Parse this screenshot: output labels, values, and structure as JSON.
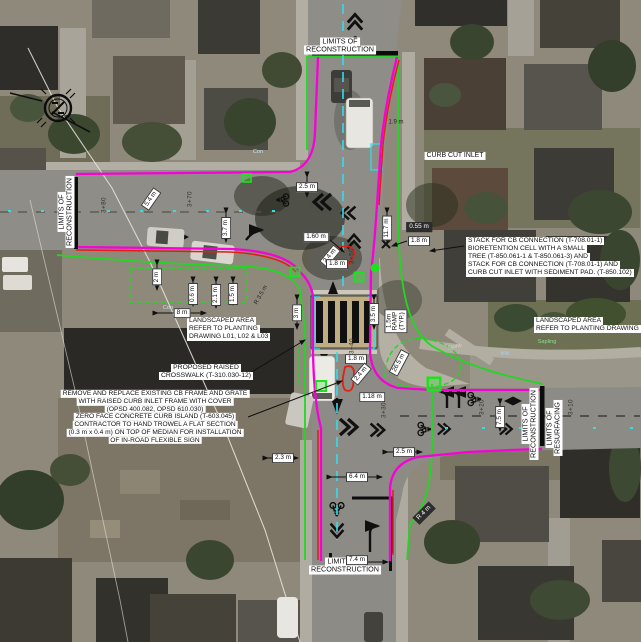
{
  "drawing": {
    "type_label": "intersection reconstruction plan over aerial photo",
    "colors": {
      "proposed_curb_magenta": "#f702d6",
      "limits_green": "#21d821",
      "centerline_cyan": "#34dce9",
      "existing_remove_red": "#e02015",
      "marking_black": "#101010",
      "label_bg": "#ffffff",
      "label_text": "#0f0f0f"
    }
  },
  "annotations": [
    {
      "id": "limits-of-reconstruction-top",
      "lines": [
        "LIMITS OF",
        "RECONSTRUCTION"
      ],
      "x": 340,
      "y": 46,
      "rot": 0,
      "anchor": "c",
      "cls": "center",
      "fs": 7.2
    },
    {
      "id": "limits-of-reconstruction-left",
      "lines": [
        "LIMITS OF",
        "RECONSTRUCTION"
      ],
      "x": 66,
      "y": 212,
      "rot": -90,
      "anchor": "c",
      "cls": "center",
      "fs": 7.2
    },
    {
      "id": "limits-of-reconstruction-right",
      "lines": [
        "LIMITS OF",
        "RECONSTRUCTION"
      ],
      "x": 530,
      "y": 424,
      "rot": -90,
      "anchor": "c",
      "cls": "center",
      "fs": 7.2
    },
    {
      "id": "limits-of-resurfacing-right",
      "lines": [
        "LIMITS OF",
        "RESURFACING"
      ],
      "x": 554,
      "y": 428,
      "rot": -90,
      "anchor": "c",
      "cls": "center",
      "fs": 7.2
    },
    {
      "id": "limits-of-reconstruction-bottom",
      "lines": [
        "LIMITS OF",
        "RECONSTRUCTION"
      ],
      "x": 345,
      "y": 566,
      "rot": 0,
      "anchor": "c",
      "cls": "center",
      "fs": 7.2
    },
    {
      "id": "curb-cut-inlet-note",
      "lines": [
        "CURB CUT INLET"
      ],
      "x": 455,
      "y": 156,
      "rot": 0,
      "anchor": "c",
      "cls": "center",
      "fs": 6.9
    },
    {
      "id": "stack-cb-connection-note",
      "lines": [
        "STACK FOR CB CONNECTION (T-708.01-1)",
        "BIORETENTION CELL WITH A SMALL",
        "TREE (T-850.061-1 & T-850.061-3) AND",
        "STACK FOR CB CONNECTION (T-708.01-1) AND",
        "CURB CUT INLET WITH SEDIMENT PAD. (T-850.102)"
      ],
      "x": 466,
      "y": 237,
      "rot": 0,
      "anchor": "tl",
      "cls": "left",
      "fs": 6.7
    },
    {
      "id": "landscaped-area-left-note",
      "lines": [
        "LANDSCAPED AREA",
        "REFER TO PLANTING",
        "DRAWING L01, L02 & L03"
      ],
      "x": 187,
      "y": 317,
      "rot": 0,
      "anchor": "tl",
      "cls": "left",
      "fs": 6.7
    },
    {
      "id": "landscaped-area-right-note",
      "lines": [
        "LANDSCAPED AREA",
        "REFER TO PLANTING DRAWING L01"
      ],
      "x": 534,
      "y": 317,
      "rot": 0,
      "anchor": "tl",
      "cls": "left",
      "fs": 6.7
    },
    {
      "id": "proposed-raised-crosswalk-note",
      "lines": [
        "PROPOSED RAISED",
        "CROSSWALK (T-310.030-12)"
      ],
      "x": 206,
      "y": 372,
      "rot": 0,
      "anchor": "c",
      "cls": "center",
      "fs": 6.8
    },
    {
      "id": "remove-replace-cb-note",
      "lines": [
        "REMOVE AND REPLACE EXISTING CB FRAME AND GRATE",
        "WITH RAISED CURB INLET FRAME WITH COVER",
        "(OPSD 400.082, OPSD 610.030)",
        "ZERO FACE CONCRETE CURB ISLAND (T-603.045)",
        "CONTRACTOR TO HAND TROWEL A FLAT SECTION",
        "(0.3 m x 0.4 m) ON TOP OF MEDIAN FOR INSTALLATION",
        "OF IN-ROAD FLEXIBLE SIGN"
      ],
      "x": 155,
      "y": 417,
      "rot": 0,
      "anchor": "c",
      "cls": "center",
      "fs": 6.6
    }
  ],
  "dimension_chips": [
    {
      "t": "2.5 m",
      "x": 307,
      "y": 187,
      "r": 0,
      "s": "w"
    },
    {
      "t": "1.60 m",
      "x": 316,
      "y": 237,
      "r": 0,
      "s": "w"
    },
    {
      "t": "2.4 m",
      "x": 330,
      "y": 256,
      "r": -50,
      "s": "w"
    },
    {
      "t": "1.8 m",
      "x": 337,
      "y": 264,
      "r": 0,
      "s": "w"
    },
    {
      "t": "11.7 m",
      "x": 387,
      "y": 228,
      "r": -90,
      "s": "w"
    },
    {
      "t": "0.55 m",
      "x": 419,
      "y": 227,
      "r": 0,
      "s": "d"
    },
    {
      "t": "1.8 m",
      "x": 419,
      "y": 241,
      "r": 0,
      "s": "w"
    },
    {
      "t": "3.7 m",
      "x": 226,
      "y": 228,
      "r": -90,
      "s": "w"
    },
    {
      "t": "5.4 m",
      "x": 151,
      "y": 199,
      "r": -55,
      "s": "w"
    },
    {
      "t": "2 m",
      "x": 157,
      "y": 277,
      "r": -90,
      "s": "w"
    },
    {
      "t": "0.6 m",
      "x": 193,
      "y": 294,
      "r": -90,
      "s": "w"
    },
    {
      "t": "2.1 m",
      "x": 216,
      "y": 295,
      "r": -90,
      "s": "w"
    },
    {
      "t": "1.5 m",
      "x": 233,
      "y": 294,
      "r": -90,
      "s": "w"
    },
    {
      "t": "8 m",
      "x": 182,
      "y": 313,
      "r": 0,
      "s": "w"
    },
    {
      "t": "3 m",
      "x": 297,
      "y": 313,
      "r": -90,
      "s": "w"
    },
    {
      "t": "3.5 m",
      "x": 374,
      "y": 314,
      "r": -90,
      "s": "w"
    },
    {
      "t": "1.8 m",
      "x": 356,
      "y": 359,
      "r": 0,
      "s": "w"
    },
    {
      "t": "2.4 m",
      "x": 361,
      "y": 374,
      "r": -50,
      "s": "w"
    },
    {
      "t": "1.18 m",
      "x": 372,
      "y": 397,
      "r": 0,
      "s": "w"
    },
    {
      "t": "26.5 m",
      "x": 399,
      "y": 363,
      "r": -62,
      "s": "w"
    },
    {
      "t": "2.5 m",
      "x": 404,
      "y": 452,
      "r": 0,
      "s": "w"
    },
    {
      "t": "6.4 m",
      "x": 357,
      "y": 477,
      "r": 0,
      "s": "w"
    },
    {
      "t": "2.3 m",
      "x": 283,
      "y": 458,
      "r": 0,
      "s": "w"
    },
    {
      "t": "7.4 m",
      "x": 357,
      "y": 560,
      "r": 0,
      "s": "w"
    },
    {
      "t": "R 4 m",
      "x": 424,
      "y": 513,
      "r": -45,
      "s": "d"
    },
    {
      "t": "7.5 m",
      "x": 500,
      "y": 417,
      "r": -90,
      "s": "w"
    },
    {
      "t": "1.9 m",
      "x": 396,
      "y": 122,
      "r": 0,
      "s": "p"
    },
    {
      "t": "R 3.5 m",
      "x": 261,
      "y": 295,
      "r": -60,
      "s": "p"
    }
  ],
  "ramp_chip": {
    "lines": [
      "1.5m",
      "RAMP",
      "(TYP.)"
    ],
    "x": 396,
    "y": 321,
    "r": -90,
    "s": "w"
  },
  "stations": [
    {
      "t": "3+80",
      "x": 104,
      "y": 205,
      "r": -90
    },
    {
      "t": "3+70",
      "x": 190,
      "y": 199,
      "r": -90
    },
    {
      "t": "3+50",
      "x": 352,
      "y": 256,
      "r": -90
    },
    {
      "t": "3+40",
      "x": 352,
      "y": 346,
      "r": -90
    },
    {
      "t": "3+30",
      "x": 384,
      "y": 410,
      "r": -90
    },
    {
      "t": "3+20",
      "x": 482,
      "y": 407,
      "r": -90
    },
    {
      "t": "3+10",
      "x": 571,
      "y": 407,
      "r": -90
    }
  ],
  "map_texts": [
    {
      "t": "Sapling",
      "x": 547,
      "y": 342,
      "r": 0,
      "c": "#8fe08f"
    },
    {
      "t": "Con",
      "x": 168,
      "y": 308,
      "r": 0,
      "c": "#cfe6f5"
    },
    {
      "t": "Con",
      "x": 258,
      "y": 152,
      "r": 0,
      "c": "#cfe6f5"
    },
    {
      "t": "Stone",
      "x": 455,
      "y": 347,
      "r": -14,
      "c": "#d8d4c8"
    },
    {
      "t": "BW",
      "x": 505,
      "y": 354,
      "r": 0,
      "c": "#9fd4f0"
    }
  ]
}
